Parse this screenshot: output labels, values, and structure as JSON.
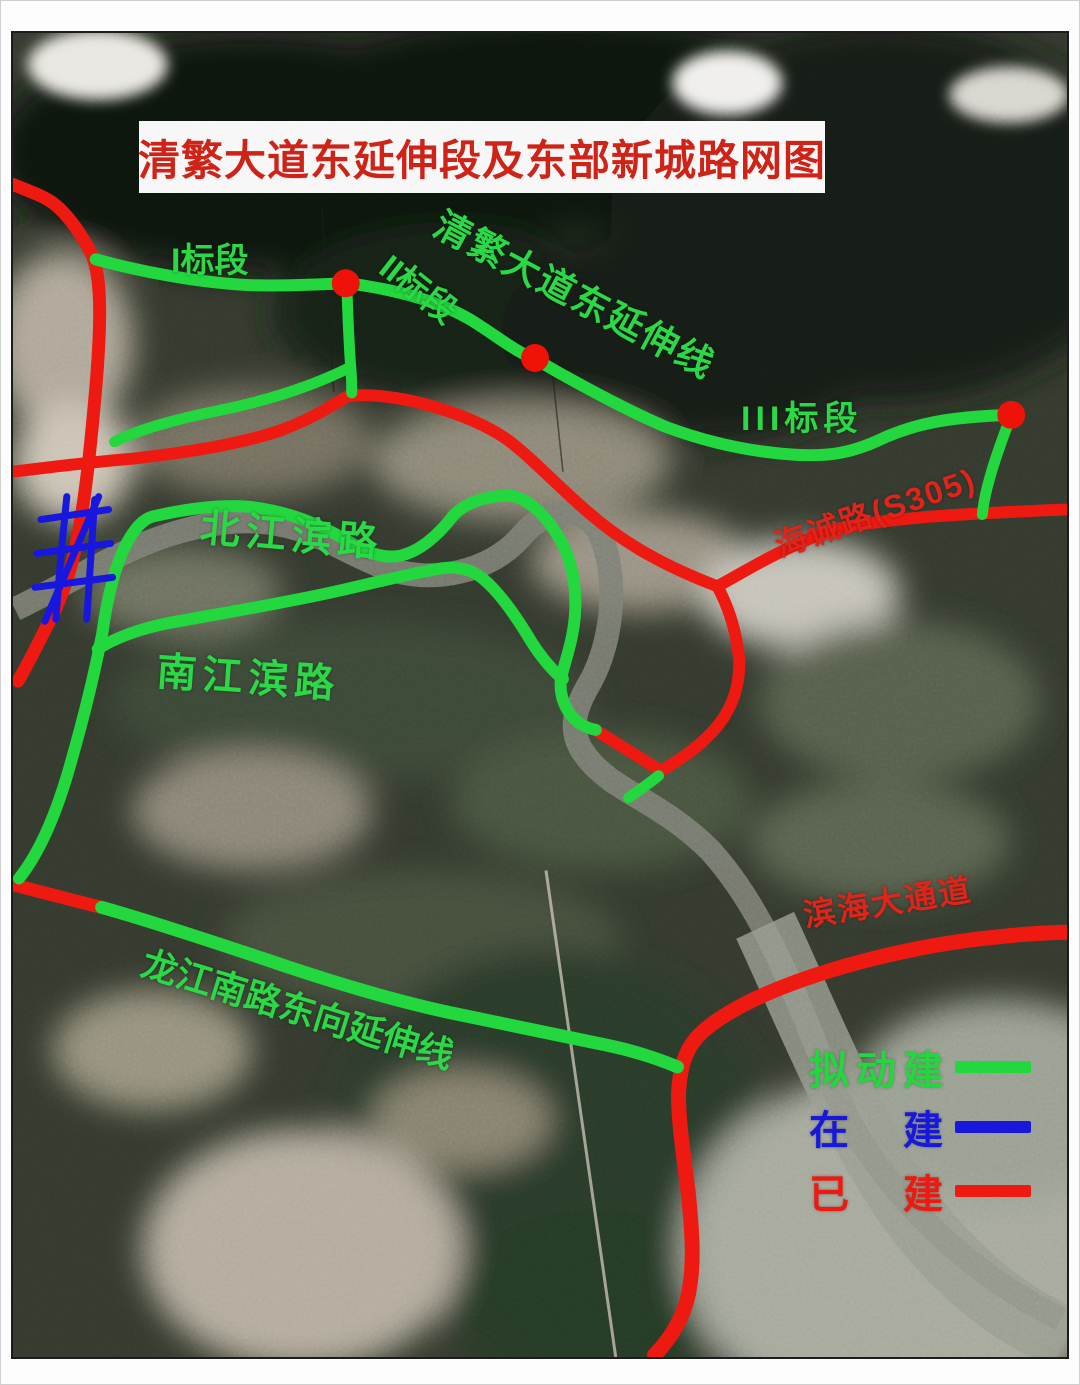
{
  "title": "清繁大道东延伸段及东部新城路网图",
  "map_labels": {
    "section_1": "I标段",
    "section_2": "II标段",
    "section_3": "III标段",
    "qingfan_extension": "清繁大道东延伸线",
    "beijiang_binlu": "北江滨路",
    "nanjiang_binlu": "南江滨路",
    "longjiang_extension": "龙江南路东向延伸线",
    "haicheng_road": "海诚路(S305)",
    "binhai_corridor": "滨海大通道"
  },
  "legend": {
    "items": [
      {
        "label": "拟动建",
        "status": "planned",
        "color": "#23d73e"
      },
      {
        "label": "在 建",
        "status": "under_construction",
        "color": "#1717dd"
      },
      {
        "label": "已 建",
        "status": "built",
        "color": "#ee1a12"
      }
    ]
  },
  "colors": {
    "planned": "#23d73e",
    "under_construction": "#1717dd",
    "built": "#ee1a12",
    "junction_dot": "#ee1208",
    "title_red": "#cf2318",
    "label_green": "#2bd846",
    "label_red": "#e0241a"
  }
}
